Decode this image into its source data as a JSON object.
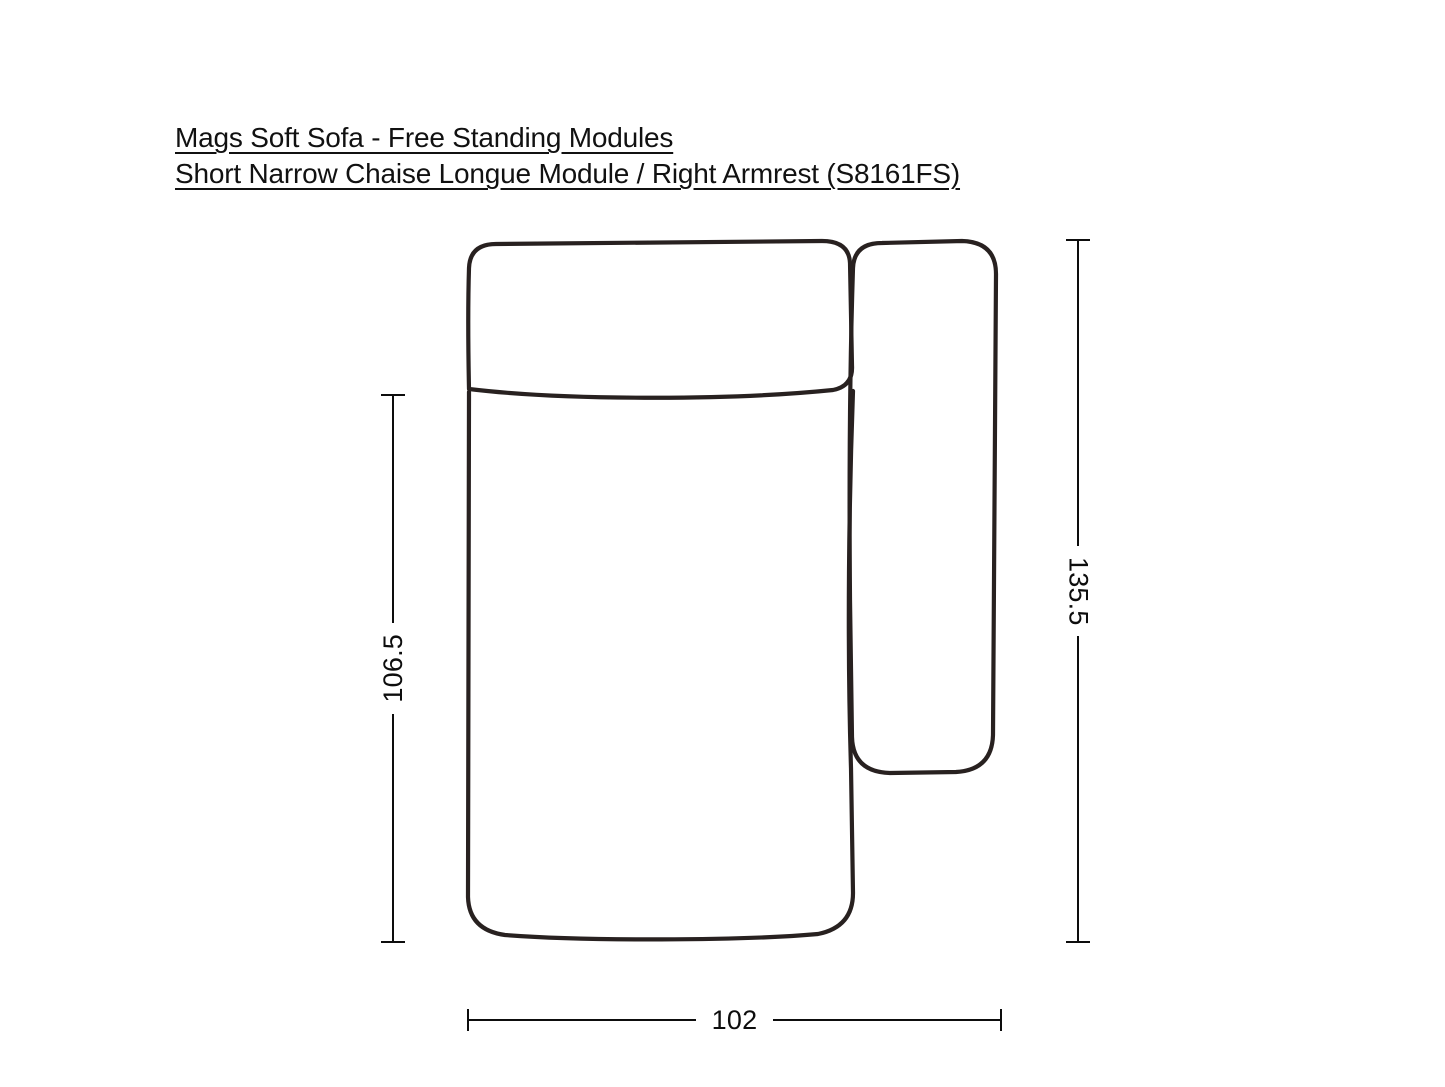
{
  "title": {
    "line1": "Mags Soft Sofa - Free Standing Modules",
    "line2": "Short Narrow Chaise Longue Module / Right Armrest (S8161FS)"
  },
  "dimensions": {
    "left_label": "106.5",
    "right_label": "135.5",
    "bottom_label": "102"
  },
  "diagram": {
    "description": "top view line drawing of a short narrow chaise longue sofa module with right armrest",
    "colors": {
      "outline": "#282120",
      "dimension_lines": "#0d0d0d",
      "background": "#ffffff"
    }
  }
}
